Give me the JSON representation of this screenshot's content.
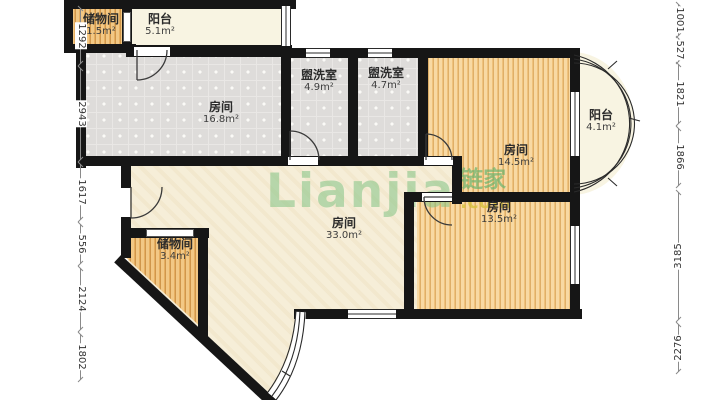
{
  "watermark": {
    "brand": "Lianjia",
    "cjk": "链家",
    "tld": ".com"
  },
  "rooms": [
    {
      "key": "storage-top",
      "label": "储物间",
      "area": "1.5m²"
    },
    {
      "key": "balcony-top",
      "label": "阳台",
      "area": "5.1m²"
    },
    {
      "key": "bedroom-left",
      "label": "房间",
      "area": "16.8m²"
    },
    {
      "key": "washroom-1",
      "label": "盥洗室",
      "area": "4.9m²"
    },
    {
      "key": "washroom-2",
      "label": "盥洗室",
      "area": "4.7m²"
    },
    {
      "key": "bedroom-right-top",
      "label": "房间",
      "area": "14.5m²"
    },
    {
      "key": "balcony-right",
      "label": "阳台",
      "area": "4.1m²"
    },
    {
      "key": "bedroom-right-bottom",
      "label": "房间",
      "area": "13.5m²"
    },
    {
      "key": "living-room",
      "label": "房间",
      "area": "33.0m²"
    },
    {
      "key": "storage-bottom",
      "label": "储物间",
      "area": "3.4m²"
    }
  ],
  "dimensions": {
    "left": [
      "1292",
      "2943",
      "1617",
      "556",
      "2124",
      "1802"
    ],
    "right": [
      "1001",
      "527",
      "1821",
      "1866",
      "3185",
      "2276"
    ]
  },
  "colors": {
    "wall": "#161616",
    "wood_floor": "#efc27c",
    "tile_floor": "#dedcda",
    "living_floor": "#f6eed8",
    "watermark_green": "#82c385",
    "watermark_yellow": "#d6c03c"
  }
}
